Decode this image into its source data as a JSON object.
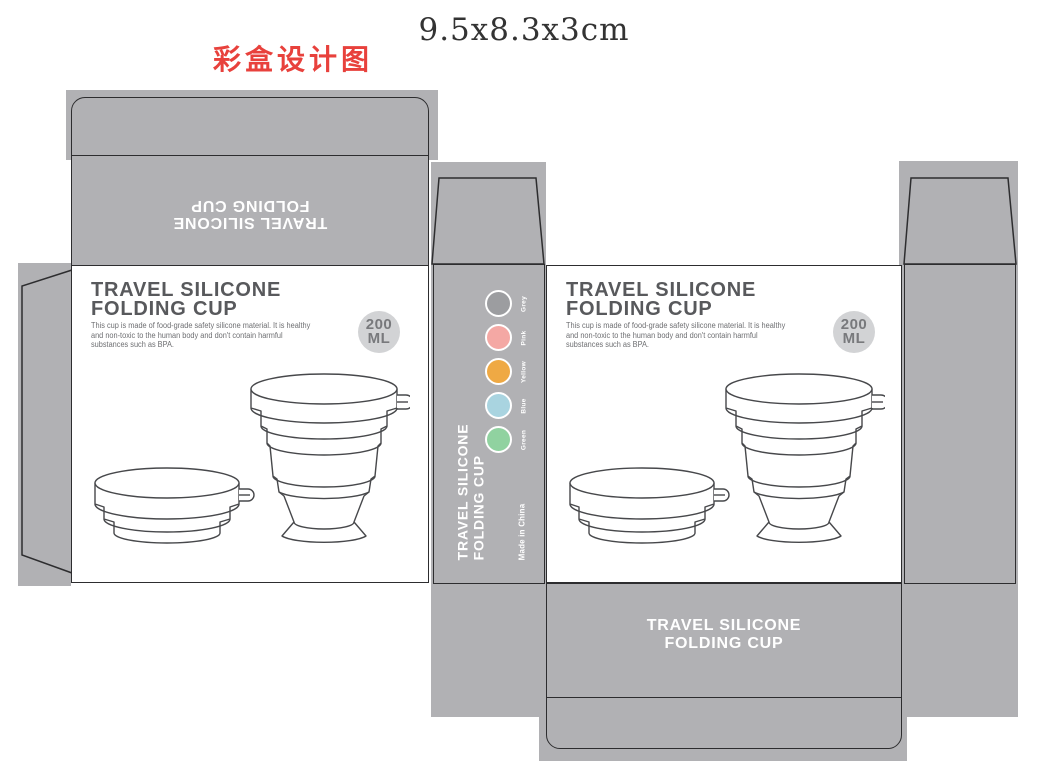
{
  "header": {
    "design_label": "彩盒设计图",
    "box_size": "9.5x8.3x3cm"
  },
  "product": {
    "name_line1": "TRAVEL SILICONE",
    "name_line2": "FOLDING CUP",
    "description_lines": [
      "This cup is made of food-grade safety silicone material. It is healthy",
      "and non-toxic to the human body and don't contain harmful",
      "substances such as BPA."
    ],
    "capacity_value": "200",
    "capacity_unit": "ML",
    "origin_text": "Made in China"
  },
  "spine": {
    "title_line1": "TRAVEL SILICONE",
    "title_line2": "FOLDING CUP",
    "swatches": [
      {
        "name": "Grey",
        "color": "#9c9da0"
      },
      {
        "name": "Pink",
        "color": "#f4a8a4"
      },
      {
        "name": "Yellow",
        "color": "#efa944"
      },
      {
        "name": "Blue",
        "color": "#a9d4e0"
      },
      {
        "name": "Green",
        "color": "#90d2a0"
      }
    ]
  },
  "panels": {
    "top_reversed": {
      "line1": "TRAVEL SILICONE",
      "line2": "FOLDING CUP"
    },
    "bottom": {
      "line1": "TRAVEL SILICONE",
      "line2": "FOLDING CUP"
    }
  },
  "colors": {
    "panel_gray": "#b1b1b4",
    "outline_dark": "#2d2d2f",
    "heading_gray": "#58595c",
    "body_gray": "#6e6f72",
    "badge_bg": "#d2d3d5",
    "badge_text": "#78797c",
    "accent_red": "#e8413c"
  }
}
